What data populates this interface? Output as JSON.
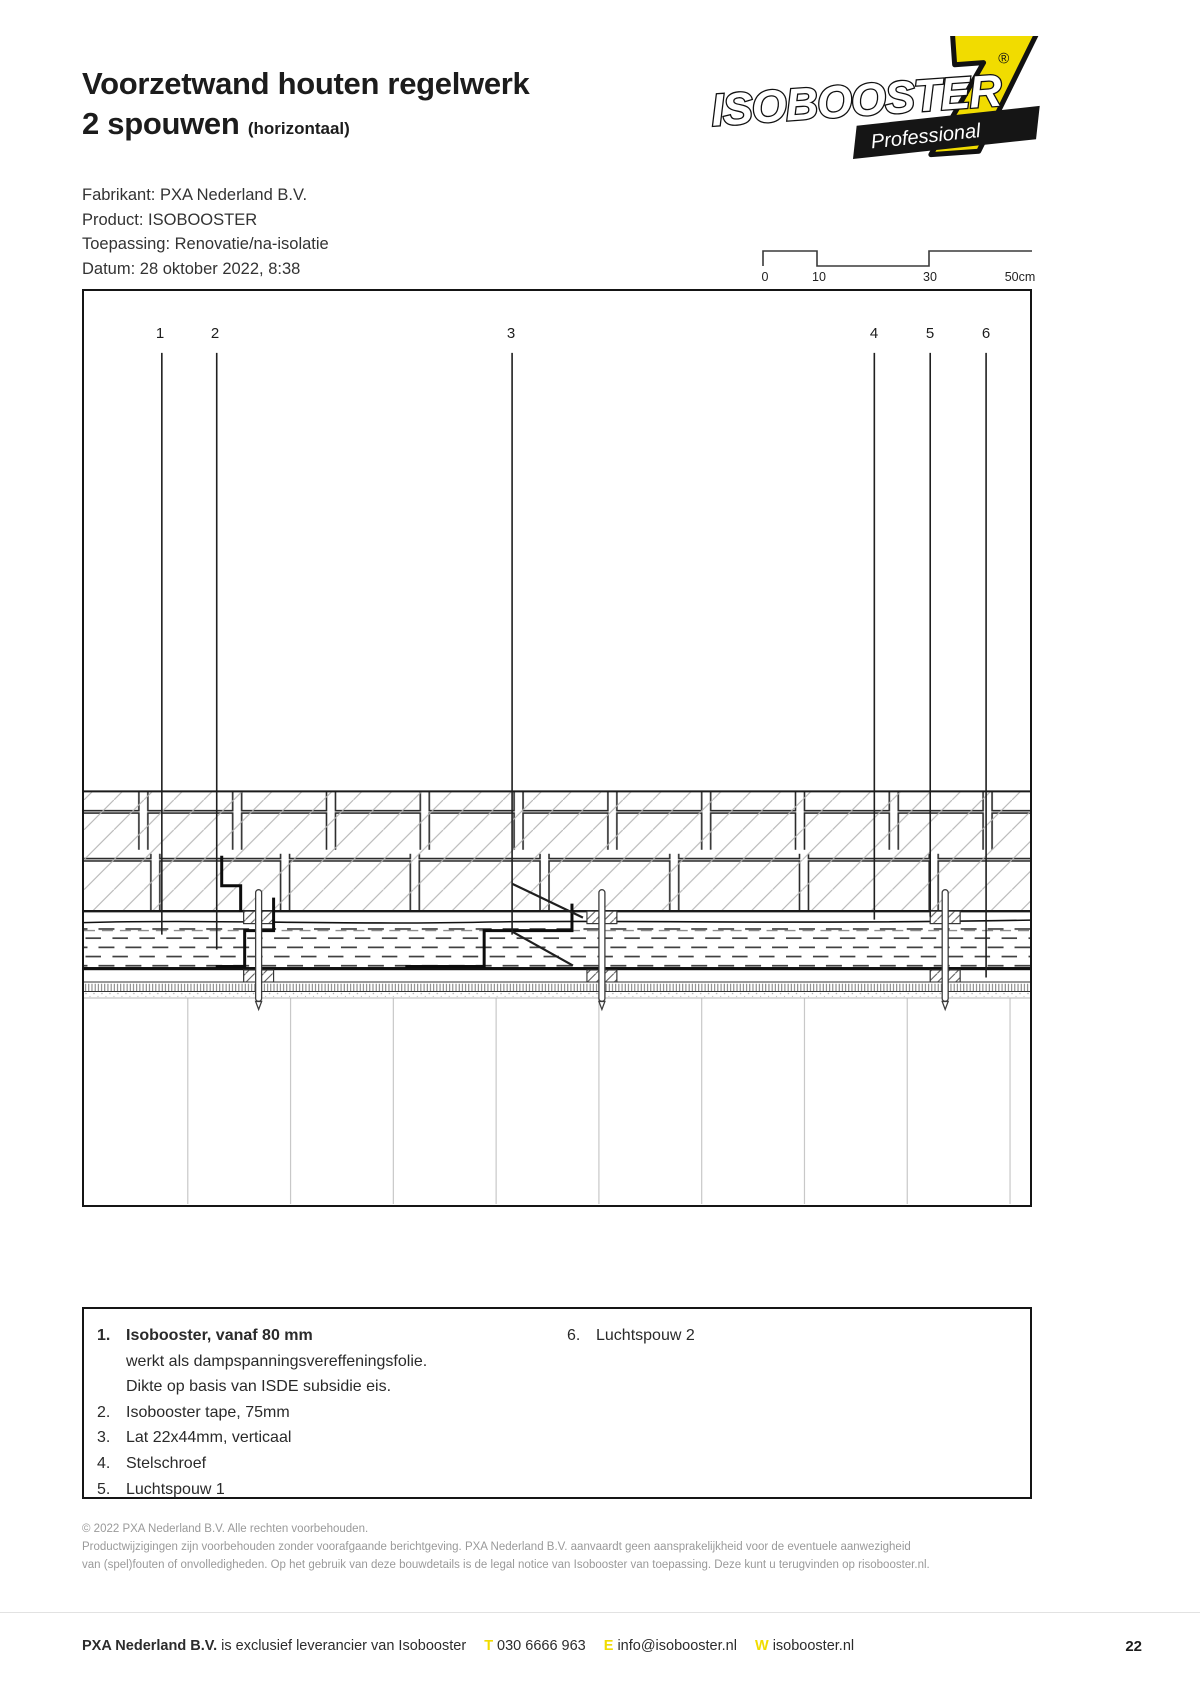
{
  "header": {
    "title_line1": "Voorzetwand houten regelwerk",
    "title_line2": "2 spouwen",
    "title_suffix": "(horizontaal)",
    "logo": {
      "brand": "ISOBOOSTER",
      "registered": "®",
      "seven": "7",
      "badge": "Professional"
    }
  },
  "info": {
    "lines": [
      "Fabrikant: PXA Nederland B.V.",
      "Product: ISOBOOSTER",
      "Toepassing: Renovatie/na-isolatie",
      "Datum: 28 oktober 2022, 8:38"
    ]
  },
  "scalebar": {
    "labels": [
      "0",
      "10",
      "30",
      "50cm"
    ]
  },
  "drawing": {
    "callouts": [
      "1",
      "2",
      "3",
      "4",
      "5",
      "6"
    ]
  },
  "legend": {
    "items": [
      {
        "num": "1.",
        "text": "Isobooster, vanaf 80 mm",
        "extra": [
          "werkt als dampspanningsvereffeningsfolie.",
          "Dikte op basis van ISDE subsidie eis."
        ]
      },
      {
        "num": "2.",
        "text": "Isobooster tape, 75mm"
      },
      {
        "num": "3.",
        "text": "Lat 22x44mm, verticaal"
      },
      {
        "num": "4.",
        "text": "Stelschroef"
      },
      {
        "num": "5.",
        "text": "Luchtspouw 1"
      },
      {
        "num": "6.",
        "text": "Luchtspouw 2"
      }
    ]
  },
  "disclaimer": {
    "lines": [
      "© 2022 PXA Nederland B.V. Alle rechten voorbehouden.",
      "Productwijzigingen zijn voorbehouden zonder voorafgaande berichtgeving. PXA Nederland B.V. aanvaardt geen aansprakelijkheid voor de eventuele aanwezigheid",
      "van (spel)fouten of onvolledigheden. Op het gebruik van deze bouwdetails is de legal notice van Isobooster van toepassing. Deze kunt u terugvinden op risobooster.nl."
    ]
  },
  "footer": {
    "company": "PXA Nederland B.V.",
    "tagline": " is exclusief leverancier van Isobooster",
    "phone_label": "T",
    "phone": "030 6666 963",
    "email_label": "E",
    "email": "info@isobooster.nl",
    "web_label": "W",
    "web": "isobooster.nl",
    "page": "22"
  },
  "colors": {
    "accent_yellow": "#f1dc00",
    "line_dark": "#151515",
    "hatch_gray": "#b3b3b3"
  }
}
